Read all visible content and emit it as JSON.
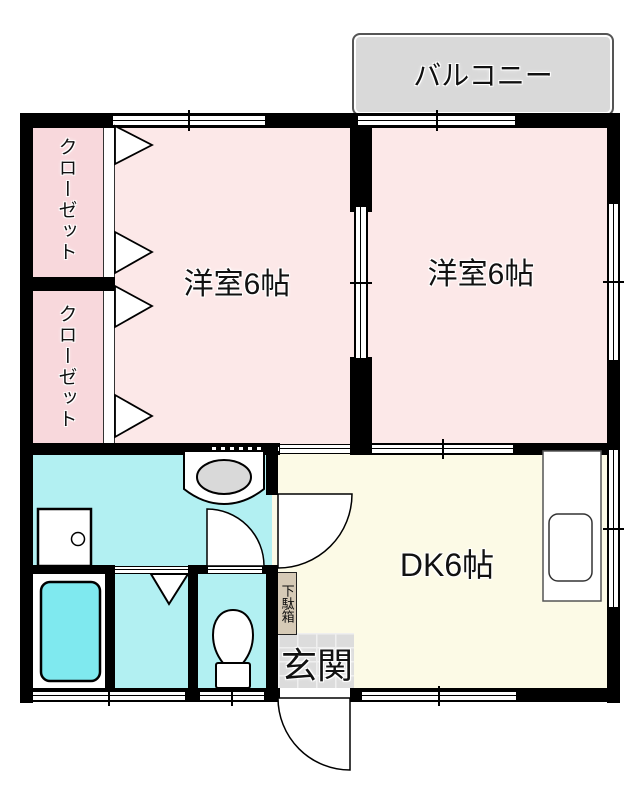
{
  "rooms": {
    "balcony": "バルコニー",
    "bedroom_left": "洋室6帖",
    "bedroom_right": "洋室6帖",
    "closet_top": "クローゼット",
    "closet_bottom": "クローゼット",
    "dining_kitchen": "DK6帖",
    "entrance": "玄関",
    "shoe_cabinet": "下駄箱"
  },
  "colors": {
    "wall": "#000000",
    "bedroom-pink": "#fce8e8",
    "closet-pink": "#f8d8dc",
    "sanitary-cyan": "#b2f0f2",
    "bathtub-cyan": "#7fe9ef",
    "dk-cream": "#fcfae6",
    "balcony-gray": "#d9d9d9",
    "tile-gray": "#dcdcdc",
    "shoebox-tan": "#d6cab6",
    "fixture-gray": "#d9d9d9"
  },
  "fixtures": {
    "bathtub-icon": "rounded-rectangle",
    "bath-door-icon": "folding-triangle",
    "toilet-icon": "bowl-and-tank",
    "washing-machine-icon": "square-with-drain-circle",
    "washbasin-icon": "counter-with-oval-basin",
    "kitchen-sink-icon": "counter-with-rounded-sink",
    "entrance-door-icon": "quarter-arc-swing",
    "washroom-door-icon": "quarter-arc-swing",
    "toilet-door-icon": "quarter-arc-swing",
    "closet-door-icon": "bifold-triangles",
    "sliding-door-icon": "double-line-track",
    "window-icon": "double-line-band"
  }
}
